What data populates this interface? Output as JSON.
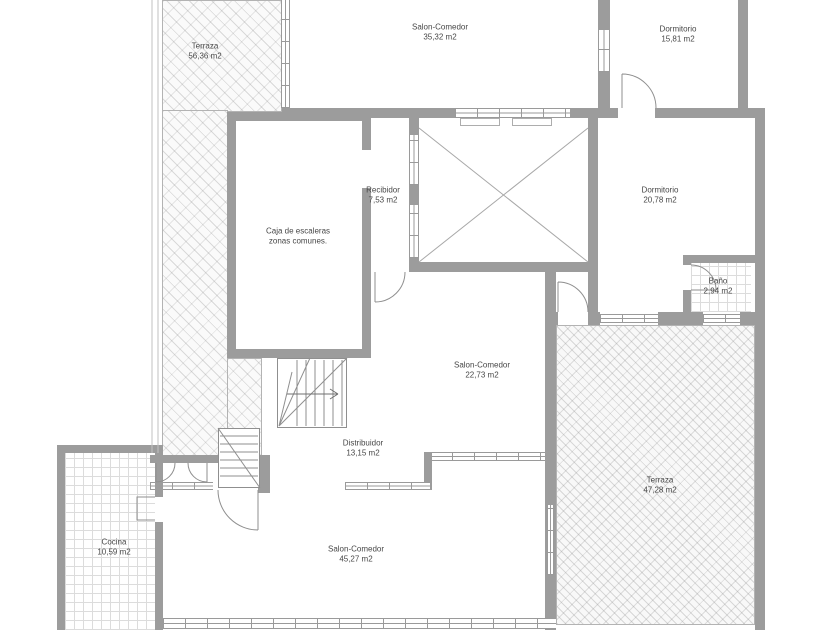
{
  "colors": {
    "wall_gray": "#9c9c9c",
    "line_gray": "#8f8f8f",
    "label_text": "#474747",
    "background": "#ffffff"
  },
  "rooms": [
    {
      "name": "Terraza",
      "area": "56,36 m2"
    },
    {
      "name": "Salon-Comedor",
      "area": "35,32 m2"
    },
    {
      "name": "Dormitorio",
      "area": "15,81 m2"
    },
    {
      "name": "Recibidor",
      "area": "7,53 m2"
    },
    {
      "name": "Caja de escaleras",
      "area": "zonas comunes."
    },
    {
      "name": "Dormitorio",
      "area": "20,78 m2"
    },
    {
      "name": "Baño",
      "area": "2,94 m2"
    },
    {
      "name": "Salon-Comedor",
      "area": "22,73 m2"
    },
    {
      "name": "Distribuidor",
      "area": "13,15 m2"
    },
    {
      "name": "Terraza",
      "area": "47,28 m2"
    },
    {
      "name": "Cocina",
      "area": "10,59 m2"
    },
    {
      "name": "Salon-Comedor",
      "area": "45,27 m2"
    }
  ]
}
